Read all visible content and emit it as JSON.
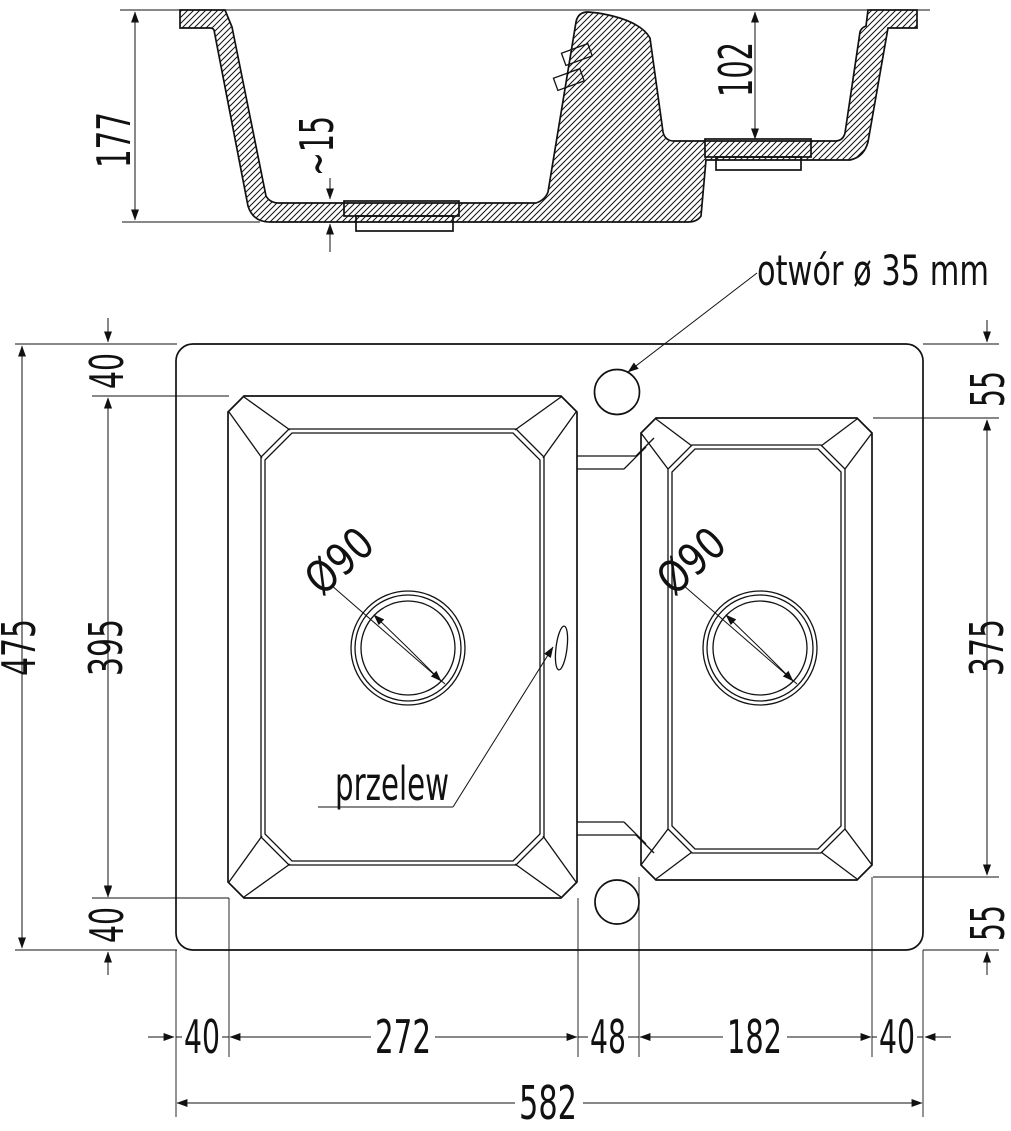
{
  "drawing": {
    "type": "technical-drawing-sink",
    "line_color": "#111111",
    "background_color": "#ffffff"
  },
  "cross_section": {
    "total_depth": "177",
    "base_thickness": "~15",
    "right_bowl_depth": "102"
  },
  "plan": {
    "faucet_hole_label": "otwór ø 35 mm",
    "overflow_label": "przelew",
    "left_drain_diameter": "Ø90",
    "right_drain_diameter": "Ø90",
    "left": {
      "top_offset": "40",
      "bowl_length": "395",
      "bottom_offset": "40",
      "total_height": "475"
    },
    "right": {
      "top_offset": "55",
      "bowl_length": "375",
      "bottom_offset": "55"
    },
    "bottom": {
      "left_margin": "40",
      "left_bowl_width": "272",
      "divider_width": "48",
      "right_bowl_width": "182",
      "right_margin": "40",
      "total_width": "582"
    }
  }
}
